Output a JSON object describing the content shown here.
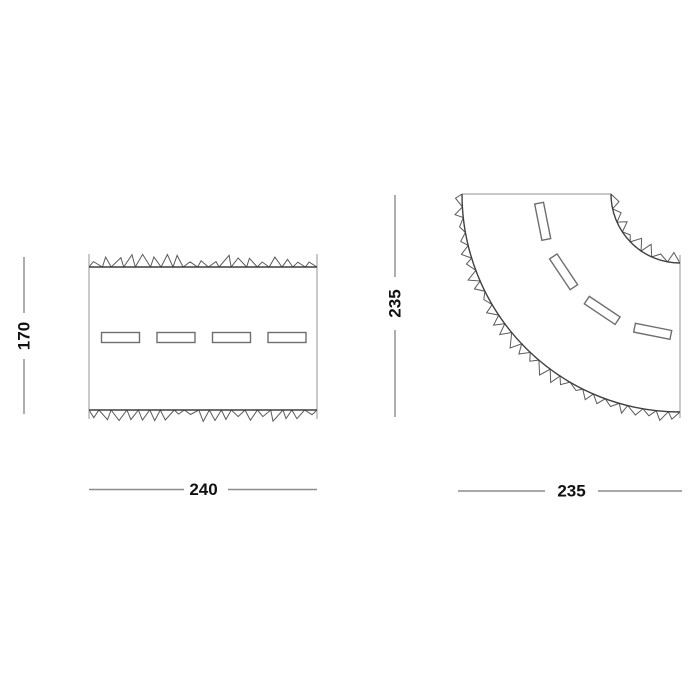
{
  "drawing": {
    "labels": {
      "straight_height": "170",
      "straight_width": "240",
      "curve_height": "235",
      "curve_width": "235"
    },
    "pieces": [
      {
        "name": "straight-road-piece",
        "width_label": "240",
        "height_label": "170",
        "lane_markings": 4
      },
      {
        "name": "curved-road-piece",
        "width_label": "235",
        "height_label": "235",
        "lane_markings": 4
      }
    ],
    "colors": {
      "background": "#ffffff",
      "piece_outline": "#3f3f3f",
      "end_edge": "#a6a6a6",
      "jagged_edge": "#5a5a5a",
      "lane_marking_outline": "#6e6e6e",
      "dimension_line": "#8c8c8c",
      "dimension_text": "#111111"
    }
  }
}
